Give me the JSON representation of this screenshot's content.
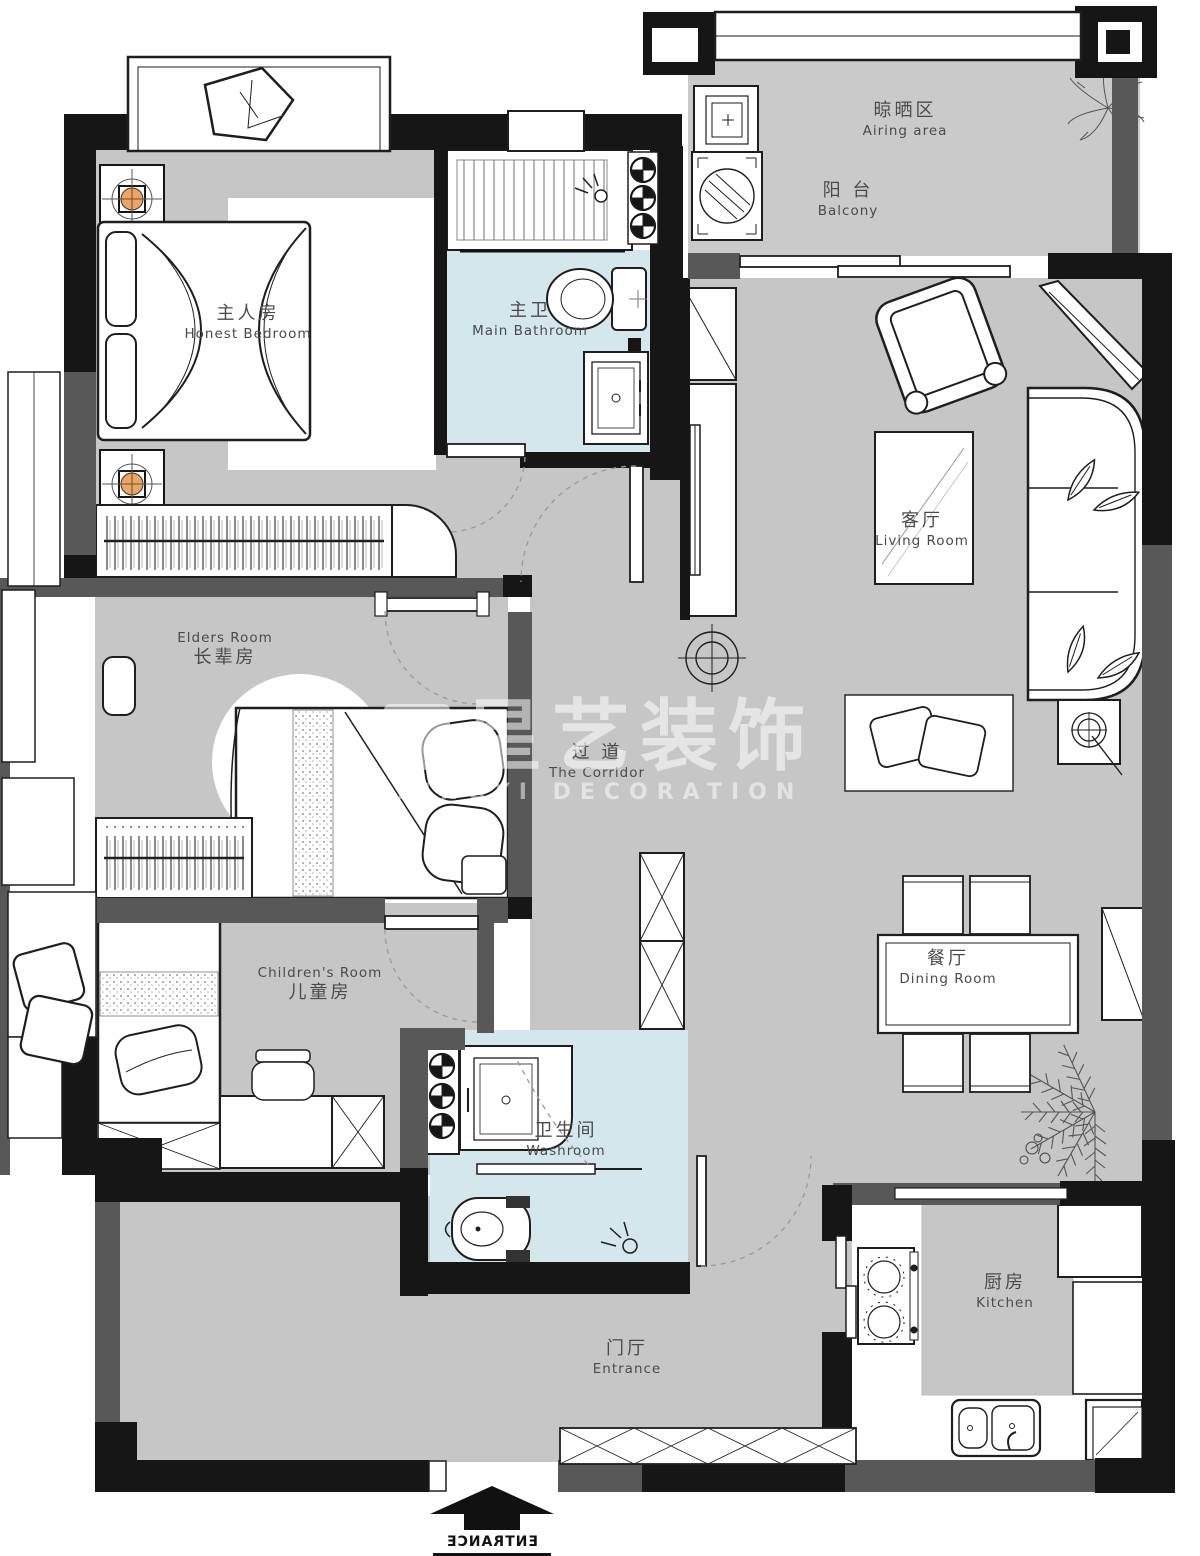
{
  "title": "Apartment Floor Plan",
  "watermark": {
    "zh": "星艺装饰",
    "en": "XINGYI DECORATION"
  },
  "rooms": {
    "airing_area": {
      "zh": "晾晒区",
      "en": "Airing area"
    },
    "balcony": {
      "zh": "阳 台",
      "en": "Balcony"
    },
    "master_bedroom": {
      "zh": "主人房",
      "en": "Honest Bedroom"
    },
    "main_bathroom": {
      "zh": "主卫",
      "en": "Main Bathroom"
    },
    "living_room": {
      "zh": "客厅",
      "en": "Living Room"
    },
    "elders_room": {
      "zh": "长辈房",
      "en": "Elders Room"
    },
    "corridor": {
      "zh": "过 道",
      "en": "The Corridor"
    },
    "children_room": {
      "zh": "儿童房",
      "en": "Children's Room"
    },
    "dining_room": {
      "zh": "餐厅",
      "en": "Dining Room"
    },
    "washroom": {
      "zh": "卫生间",
      "en": "Washroom"
    },
    "entrance_hall": {
      "zh": "门厅",
      "en": "Entrance"
    },
    "kitchen": {
      "zh": "厨房",
      "en": "Kitchen"
    }
  },
  "entrance_marker": {
    "label": "ENTRANCE"
  },
  "colors": {
    "wall_black": "#161616",
    "wall_gray": "#585858",
    "floor_gray": "#c6c6c6",
    "balcony_gray": "#cacaca",
    "bathroom_blue": "#d3e7ec",
    "lamp_orange": "#f0a45f",
    "furniture_outline": "#1e1e1e",
    "watermark_white": "rgba(255,255,255,0.55)"
  }
}
